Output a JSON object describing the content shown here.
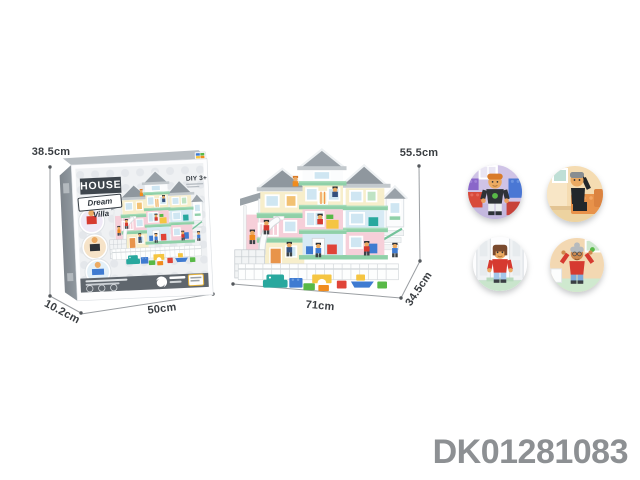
{
  "annotations": {
    "box_height": "38.5cm",
    "box_depth": "10.2cm",
    "box_width": "50cm",
    "villa_height": "55.5cm",
    "villa_width": "71cm",
    "villa_depth": "34.5cm"
  },
  "box": {
    "title": "HOUSE",
    "subtitle": "Dream Villa",
    "age_grade": "DIY 3+"
  },
  "sku": "DK01281083",
  "figures": [
    {
      "name": "boy-figure"
    },
    {
      "name": "father-figure"
    },
    {
      "name": "mother-figure"
    },
    {
      "name": "grandmother-figure"
    }
  ],
  "colors": {
    "dimension_line": "#9a9ea2",
    "dimension_dot": "#54585c",
    "dimension_text": "#3a3e42",
    "sku_text": "#8d9093",
    "box_title_bg": "#3f464d",
    "box_band": "#5f666d",
    "roof_gray": "#8f979e",
    "wall_cream": "#f7eecb",
    "wall_pink": "#f6cfd9",
    "wall_blue": "#d7eaf4",
    "slab_green": "#8fd0a8",
    "figure_red": "#d63a30",
    "block_blue": "#3f7bd1",
    "block_yellow": "#f5c542",
    "block_orange": "#f08c1e",
    "block_teal": "#28a89e",
    "block_green": "#58b947"
  }
}
